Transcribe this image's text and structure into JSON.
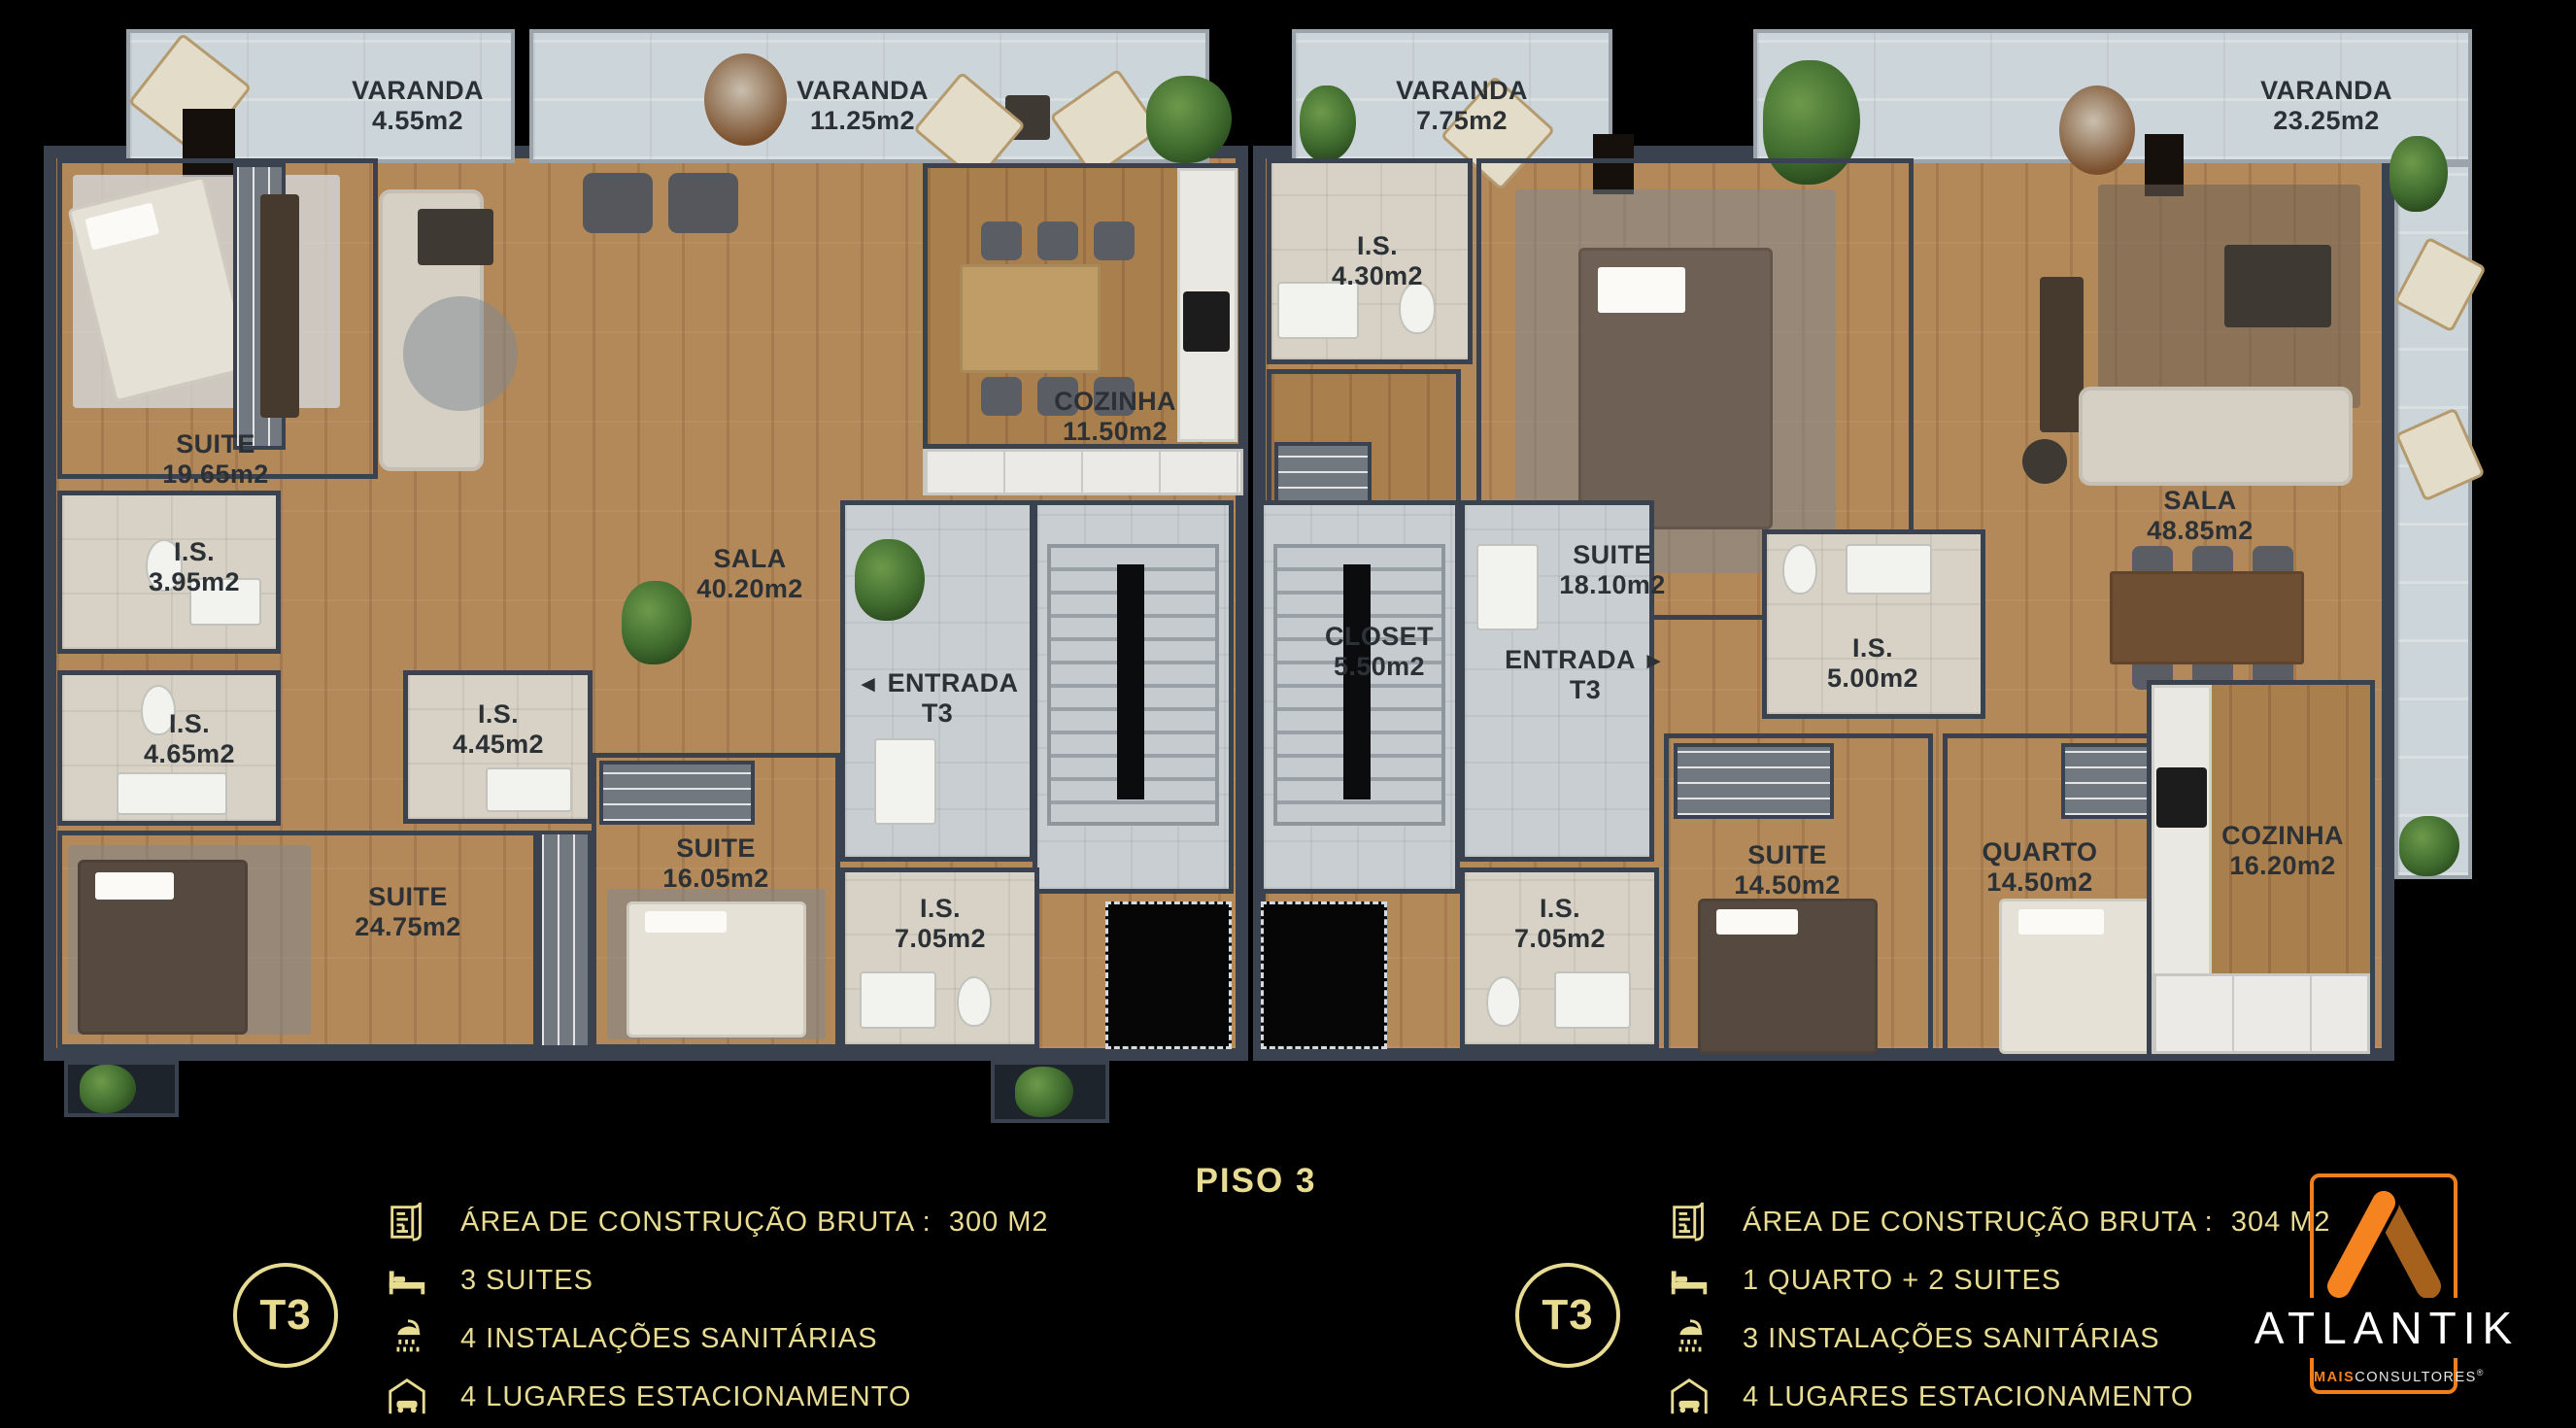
{
  "title": "PISO 3",
  "plan": {
    "verandas": [
      {
        "name": "VARANDA",
        "area": "4.55m2"
      },
      {
        "name": "VARANDA",
        "area": "11.25m2"
      },
      {
        "name": "VARANDA",
        "area": "7.75m2"
      },
      {
        "name": "VARANDA",
        "area": "23.25m2"
      }
    ],
    "left_unit": {
      "rooms": [
        {
          "name": "SUITE",
          "area": "19.65m2"
        },
        {
          "name": "I.S.",
          "area": "3.95m2"
        },
        {
          "name": "I.S.",
          "area": "4.65m2"
        },
        {
          "name": "I.S.",
          "area": "4.45m2"
        },
        {
          "name": "SUITE",
          "area": "24.75m2"
        },
        {
          "name": "SUITE",
          "area": "16.05m2"
        },
        {
          "name": "SALA",
          "area": "40.20m2"
        },
        {
          "name": "COZINHA",
          "area": "11.50m2"
        },
        {
          "name": "ENTRADA",
          "area": "T3",
          "arrow": "◄"
        },
        {
          "name": "I.S.",
          "area": "7.05m2"
        }
      ]
    },
    "right_unit": {
      "rooms": [
        {
          "name": "I.S.",
          "area": "4.30m2"
        },
        {
          "name": "CLOSET",
          "area": "5.50m2"
        },
        {
          "name": "SUITE",
          "area": "18.10m2"
        },
        {
          "name": "I.S.",
          "area": "5.00m2"
        },
        {
          "name": "SALA",
          "area": "48.85m2"
        },
        {
          "name": "ENTRADA",
          "area": "T3",
          "arrow": "►"
        },
        {
          "name": "SUITE",
          "area": "14.50m2"
        },
        {
          "name": "QUARTO",
          "area": "14.50m2"
        },
        {
          "name": "COZINHA",
          "area": "16.20m2"
        },
        {
          "name": "I.S.",
          "area": "7.05m2"
        }
      ]
    }
  },
  "legend_left": {
    "badge": "T3",
    "items": [
      {
        "icon": "blueprint-icon",
        "label": "ÁREA DE CONSTRUÇÃO BRUTA :  300 M2"
      },
      {
        "icon": "bed-icon",
        "label": "3 SUITES"
      },
      {
        "icon": "shower-icon",
        "label": "4 INSTALAÇÕES SANITÁRIAS"
      },
      {
        "icon": "car-garage-icon",
        "label": "4 LUGARES ESTACIONAMENTO"
      }
    ]
  },
  "legend_right": {
    "badge": "T3",
    "items": [
      {
        "icon": "blueprint-icon",
        "label": "ÁREA DE CONSTRUÇÃO BRUTA :  304 M2"
      },
      {
        "icon": "bed-icon",
        "label": "1 QUARTO + 2 SUITES"
      },
      {
        "icon": "shower-icon",
        "label": "3 INSTALAÇÕES SANITÁRIAS"
      },
      {
        "icon": "car-garage-icon",
        "label": "4 LUGARES ESTACIONAMENTO"
      }
    ]
  },
  "logo": {
    "brand": "ATLANTIK",
    "sub_accent": "MAIS",
    "sub_rest": "CONSULTORES",
    "registered": "®"
  },
  "colors": {
    "gold": "#e8db92",
    "brand_orange": "#f5831f",
    "brand_orange_dark": "#a6611d"
  }
}
